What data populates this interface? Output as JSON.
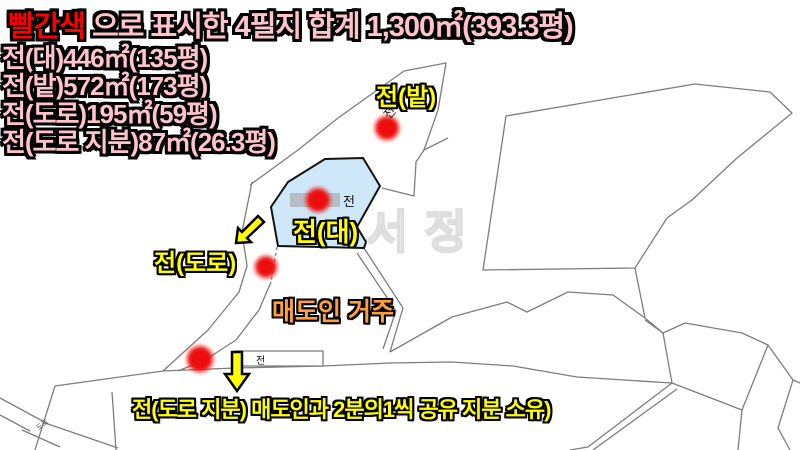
{
  "title": {
    "highlight": "빨간색",
    "rest": " 으로 표시한 4필지 합계 1,300㎡(393.3평)"
  },
  "summary_lines": [
    "전(대)446㎡(135평)",
    "전(밭)572㎡(173평)",
    "전(도로)195㎡(59평)",
    "전(도로 지분)87㎡(26.3평)"
  ],
  "map": {
    "watermark": "서정",
    "labels": {
      "field": "전(밭)",
      "house": "전(대)",
      "road": "전(도로)",
      "seller": "매도인 거주",
      "note": "전(도로 지분) 매도인과 2분의1씩 공유 지분 소유)",
      "cadastral_jeon_top": "전",
      "cadastral_jeon_center": "전",
      "cadastral_jeon_bottom": "전",
      "cadastral_road_tiny": "도로"
    }
  },
  "colors": {
    "highlight_red": "#ff0000",
    "title_pink": "#ffc3cd",
    "label_yellow": "#ffff00",
    "label_orange": "#ff9e3d",
    "marker_red": "#ee0f0f",
    "parcel_blue_fill": "#cfe8f9",
    "parcel_line_gray": "#7d7d7d",
    "watermark_gray": "#dedede",
    "censor_gray": "#b7bdc2"
  }
}
